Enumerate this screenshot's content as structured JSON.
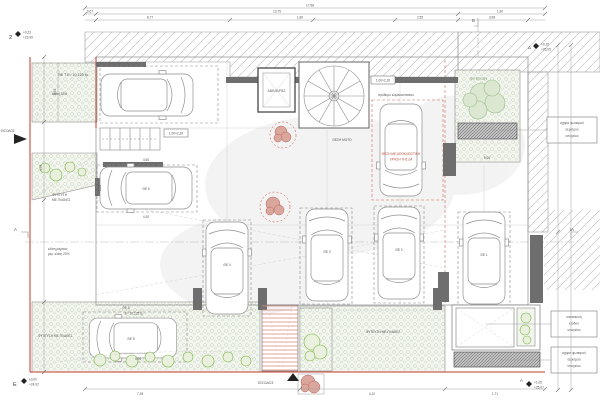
{
  "drawing": {
    "type": "basement-parking-floor-plan",
    "labels": {
      "planting_tr": "ΦΥΤΕΥΣΗ",
      "planting_plates_left": "ΦΥΤΕΥΣΗ ΜΕ ΠΛΑΚΕΣ",
      "planting_plates_right": "ΦΥΤΕΥΣΗ ΜΕ ΠΛΑΚΕΣ",
      "planting_plates_tl_a": "ΦΥΤΕΥΣΗ",
      "planting_plates_tl_b": "ΜΕ ΠΛΑΚΕΣ",
      "elevator": "ΑΝΕΛΚ/ΡΑΣ",
      "stair_lobby": "πρόθυρο κλιμακοστασίου",
      "moto": "ΘΕΣΗ ΜΟΤΟ",
      "exclusive1": "ΘΕΣΗ ΜΕ ΑΠΟΚΛΕΙΣΤΙΚΗ",
      "exclusive2": "ΧΡΗΣΗ ΤΗΣ Δ4",
      "ramp1": "κλίση ράμπας",
      "ramp2": "μεγ. κλίση 20%",
      "slope20": "κλίση 20%",
      "area7": "ΘΕ 7  Ε= 10,125 τμ",
      "area5a": "ΘΕ 5",
      "area5b": "Ε= 10,125 τμ",
      "entrance_bottom": "ΕΙΣΟΔΟΣ",
      "entrance_left": "ΕΙΣΟΔΟΣ",
      "door1": "1,00×2,20",
      "door2": "1,00×2,20"
    },
    "spots": [
      {
        "id": "ΘΕ 1"
      },
      {
        "id": "ΘΕ 2"
      },
      {
        "id": "ΘΕ 3"
      },
      {
        "id": "ΘΕ 4"
      },
      {
        "id": "ΘΕ 5"
      },
      {
        "id": "ΘΕ 6"
      }
    ],
    "callouts": [
      {
        "lines": [
          "σχάρα φωτισμού",
          "αερισμού",
          "υπογείου"
        ]
      },
      {
        "lines": [
          "κατασκευή",
          "εξόδου",
          "υπογείου"
        ]
      },
      {
        "lines": [
          "σχάρα φωτισμού",
          "αερισμού",
          "υπογείου"
        ]
      }
    ],
    "markers": {
      "tl": {
        "id": "2",
        "l1": "+0,23",
        "l2": "+23,99"
      },
      "tr": {
        "id": "Δ",
        "l1": "+0,15",
        "l2": "+25,05"
      },
      "bl": {
        "id": "Ε",
        "l1": "±0,00",
        "l2": "+24,02"
      },
      "br": {
        "id": "Α",
        "l1": "+1,05",
        "l2": "+25,07"
      },
      "section_left": "Α",
      "section_right": "ΙΑ",
      "section_top": "Β"
    },
    "dims": {
      "top1": "17,98",
      "top2": [
        "0,67",
        "13,75",
        "1,90"
      ],
      "top3": [
        "8,77",
        "1,80",
        "2,55",
        "3,98"
      ],
      "bottom": [
        "7,28",
        "4,10",
        "1,71"
      ],
      "left": [
        "0,54",
        "4,73"
      ],
      "plan": {
        "ml_top": "4,50",
        "ml_bottom": "4,30",
        "ml_side": "2,25",
        "bl_bottom": "4,00",
        "tr_width": "5,00"
      }
    },
    "colors": {
      "property_line": "#bf3b2f",
      "planting_green": "#7cb342",
      "tree_pink": "#d4958a",
      "wall_gray": "#6e6e6e"
    }
  }
}
